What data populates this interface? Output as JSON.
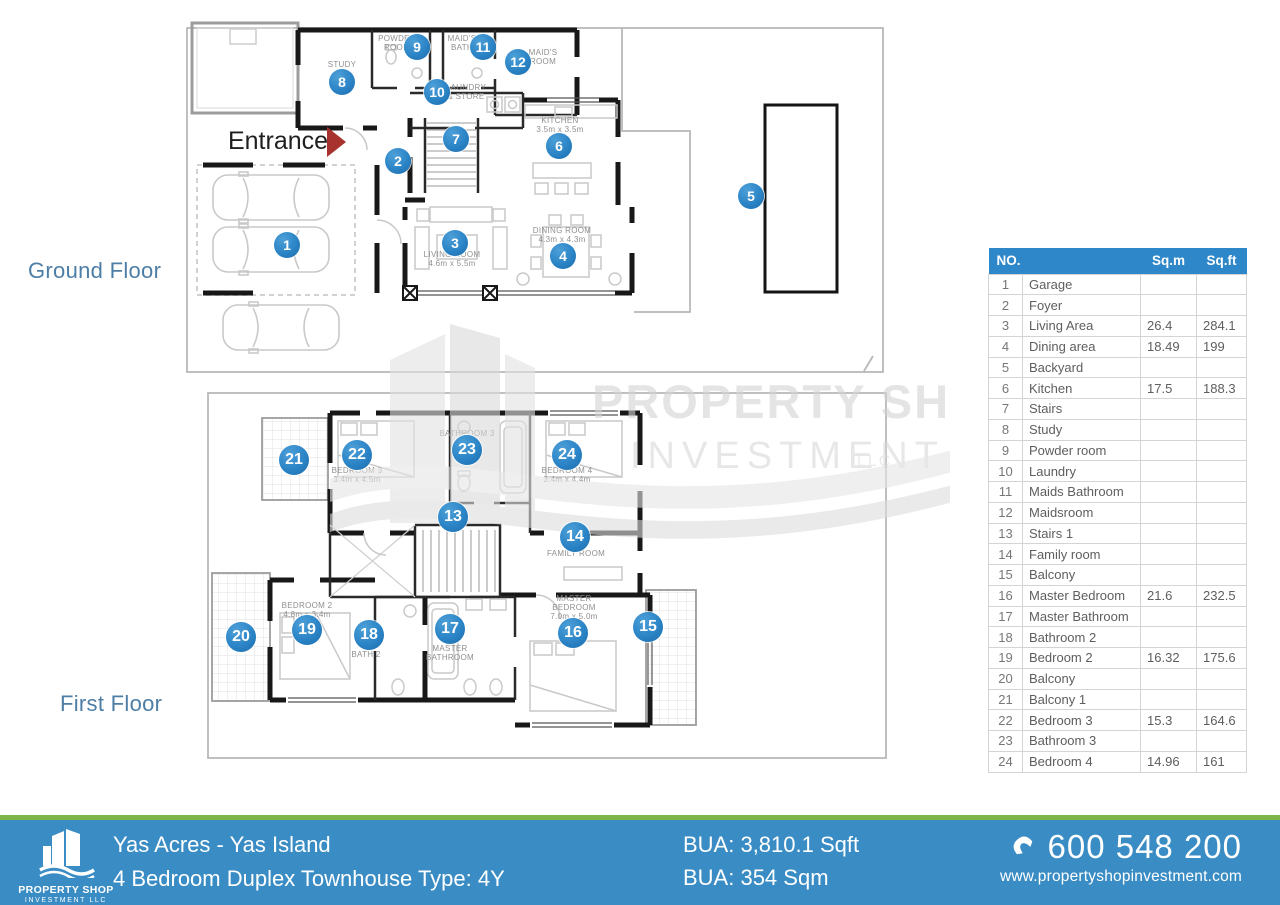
{
  "colors": {
    "accent_blue": "#2e87c8",
    "marker_blue": "#2b84c6",
    "footer_blue": "#3a8cc4",
    "footer_green": "#7fb448",
    "floor_label_blue": "#4d7ea6",
    "entrance_arrow_red": "#a8332e",
    "watermark_gray": "#d8d8d8"
  },
  "floor_labels": {
    "ground": "Ground Floor",
    "first": "First Floor"
  },
  "entrance": {
    "label": "Entrance"
  },
  "watermark": {
    "line1": "PROPERTY SHOP",
    "line2": "INVESTMENT",
    "line3": "LLC"
  },
  "markers": [
    {
      "n": 1,
      "floor": "ground",
      "x": 287,
      "y": 245
    },
    {
      "n": 2,
      "floor": "ground",
      "x": 398,
      "y": 161
    },
    {
      "n": 3,
      "floor": "ground",
      "x": 455,
      "y": 243
    },
    {
      "n": 4,
      "floor": "ground",
      "x": 563,
      "y": 256
    },
    {
      "n": 5,
      "floor": "ground",
      "x": 751,
      "y": 196
    },
    {
      "n": 6,
      "floor": "ground",
      "x": 559,
      "y": 146
    },
    {
      "n": 7,
      "floor": "ground",
      "x": 456,
      "y": 139
    },
    {
      "n": 8,
      "floor": "ground",
      "x": 342,
      "y": 82
    },
    {
      "n": 9,
      "floor": "ground",
      "x": 417,
      "y": 47
    },
    {
      "n": 10,
      "floor": "ground",
      "x": 437,
      "y": 92
    },
    {
      "n": 11,
      "floor": "ground",
      "x": 483,
      "y": 47
    },
    {
      "n": 12,
      "floor": "ground",
      "x": 518,
      "y": 62
    },
    {
      "n": 13,
      "floor": "first",
      "x": 453,
      "y": 517
    },
    {
      "n": 14,
      "floor": "first",
      "x": 575,
      "y": 537
    },
    {
      "n": 15,
      "floor": "first",
      "x": 648,
      "y": 627
    },
    {
      "n": 16,
      "floor": "first",
      "x": 573,
      "y": 633
    },
    {
      "n": 17,
      "floor": "first",
      "x": 450,
      "y": 629
    },
    {
      "n": 18,
      "floor": "first",
      "x": 369,
      "y": 635
    },
    {
      "n": 19,
      "floor": "first",
      "x": 307,
      "y": 630
    },
    {
      "n": 20,
      "floor": "first",
      "x": 241,
      "y": 637
    },
    {
      "n": 21,
      "floor": "first",
      "x": 294,
      "y": 460
    },
    {
      "n": 22,
      "floor": "first",
      "x": 357,
      "y": 455
    },
    {
      "n": 23,
      "floor": "first",
      "x": 467,
      "y": 450
    },
    {
      "n": 24,
      "floor": "first",
      "x": 567,
      "y": 455
    }
  ],
  "room_labels": [
    {
      "floor": "ground",
      "x": 342,
      "y": 60,
      "lines": [
        "STUDY"
      ]
    },
    {
      "floor": "ground",
      "x": 397,
      "y": 34,
      "lines": [
        "POWDER",
        "ROOM"
      ]
    },
    {
      "floor": "ground",
      "x": 462,
      "y": 34,
      "lines": [
        "MAID'S",
        "BATH"
      ]
    },
    {
      "floor": "ground",
      "x": 543,
      "y": 48,
      "lines": [
        "MAID'S",
        "ROOM"
      ]
    },
    {
      "floor": "ground",
      "x": 466,
      "y": 83,
      "lines": [
        "LAUNDRY",
        "& STORE"
      ]
    },
    {
      "floor": "ground",
      "x": 560,
      "y": 116,
      "lines": [
        "KITCHEN",
        "3.5m x 3.5m"
      ]
    },
    {
      "floor": "ground",
      "x": 452,
      "y": 250,
      "lines": [
        "LIVING ROOM",
        "4.6m x 5.5m"
      ]
    },
    {
      "floor": "ground",
      "x": 562,
      "y": 226,
      "lines": [
        "DINING ROOM",
        "4.3m x 4.3m"
      ]
    },
    {
      "floor": "first",
      "x": 357,
      "y": 466,
      "lines": [
        "BEDROOM 3",
        "3.4m x 4.5m"
      ]
    },
    {
      "floor": "first",
      "x": 467,
      "y": 429,
      "lines": [
        "BATHROOM 3"
      ]
    },
    {
      "floor": "first",
      "x": 567,
      "y": 466,
      "lines": [
        "BEDROOM 4",
        "3.4m x 4.4m"
      ]
    },
    {
      "floor": "first",
      "x": 576,
      "y": 549,
      "lines": [
        "FAMILY ROOM"
      ]
    },
    {
      "floor": "first",
      "x": 307,
      "y": 601,
      "lines": [
        "BEDROOM 2",
        "4.8m x 3.4m"
      ]
    },
    {
      "floor": "first",
      "x": 366,
      "y": 650,
      "lines": [
        "BATH 2"
      ]
    },
    {
      "floor": "first",
      "x": 450,
      "y": 644,
      "lines": [
        "MASTER",
        "BATHROOM"
      ]
    },
    {
      "floor": "first",
      "x": 574,
      "y": 594,
      "lines": [
        "MASTER",
        "BEDROOM",
        "7.0m x 5.0m"
      ]
    }
  ],
  "table": {
    "headers": [
      "NO.",
      "Sq.m",
      "Sq.ft"
    ],
    "rows": [
      {
        "no": 1,
        "name": "Garage",
        "sqm": "",
        "sqft": ""
      },
      {
        "no": 2,
        "name": "Foyer",
        "sqm": "",
        "sqft": ""
      },
      {
        "no": 3,
        "name": "Living Area",
        "sqm": "26.4",
        "sqft": "284.1"
      },
      {
        "no": 4,
        "name": "Dining area",
        "sqm": "18.49",
        "sqft": "199"
      },
      {
        "no": 5,
        "name": "Backyard",
        "sqm": "",
        "sqft": ""
      },
      {
        "no": 6,
        "name": "Kitchen",
        "sqm": "17.5",
        "sqft": "188.3"
      },
      {
        "no": 7,
        "name": "Stairs",
        "sqm": "",
        "sqft": ""
      },
      {
        "no": 8,
        "name": "Study",
        "sqm": "",
        "sqft": ""
      },
      {
        "no": 9,
        "name": "Powder room",
        "sqm": "",
        "sqft": ""
      },
      {
        "no": 10,
        "name": "Laundry",
        "sqm": "",
        "sqft": ""
      },
      {
        "no": 11,
        "name": "Maids Bathroom",
        "sqm": "",
        "sqft": ""
      },
      {
        "no": 12,
        "name": "Maidsroom",
        "sqm": "",
        "sqft": ""
      },
      {
        "no": 13,
        "name": "Stairs 1",
        "sqm": "",
        "sqft": ""
      },
      {
        "no": 14,
        "name": "Family room",
        "sqm": "",
        "sqft": ""
      },
      {
        "no": 15,
        "name": "Balcony",
        "sqm": "",
        "sqft": ""
      },
      {
        "no": 16,
        "name": "Master Bedroom",
        "sqm": "21.6",
        "sqft": "232.5"
      },
      {
        "no": 17,
        "name": "Master Bathroom",
        "sqm": "",
        "sqft": ""
      },
      {
        "no": 18,
        "name": "Bathroom 2",
        "sqm": "",
        "sqft": ""
      },
      {
        "no": 19,
        "name": "Bedroom 2",
        "sqm": "16.32",
        "sqft": "175.6"
      },
      {
        "no": 20,
        "name": "Balcony",
        "sqm": "",
        "sqft": ""
      },
      {
        "no": 21,
        "name": "Balcony 1",
        "sqm": "",
        "sqft": ""
      },
      {
        "no": 22,
        "name": "Bedroom 3",
        "sqm": "15.3",
        "sqft": "164.6"
      },
      {
        "no": 23,
        "name": "Bathroom 3",
        "sqm": "",
        "sqft": ""
      },
      {
        "no": 24,
        "name": "Bedroom 4",
        "sqm": "14.96",
        "sqft": "161"
      }
    ]
  },
  "footer": {
    "logo_title": "PROPERTY SHOP",
    "logo_subtitle": "INVESTMENT LLC",
    "project": "Yas Acres - Yas Island",
    "unit": "4 Bedroom Duplex Townhouse Type: 4Y",
    "bua_sqft": "BUA: 3,810.1 Sqft",
    "bua_sqm": "BUA: 354 Sqm",
    "phone": "600 548 200",
    "website": "www.propertyshopinvestment.com"
  }
}
